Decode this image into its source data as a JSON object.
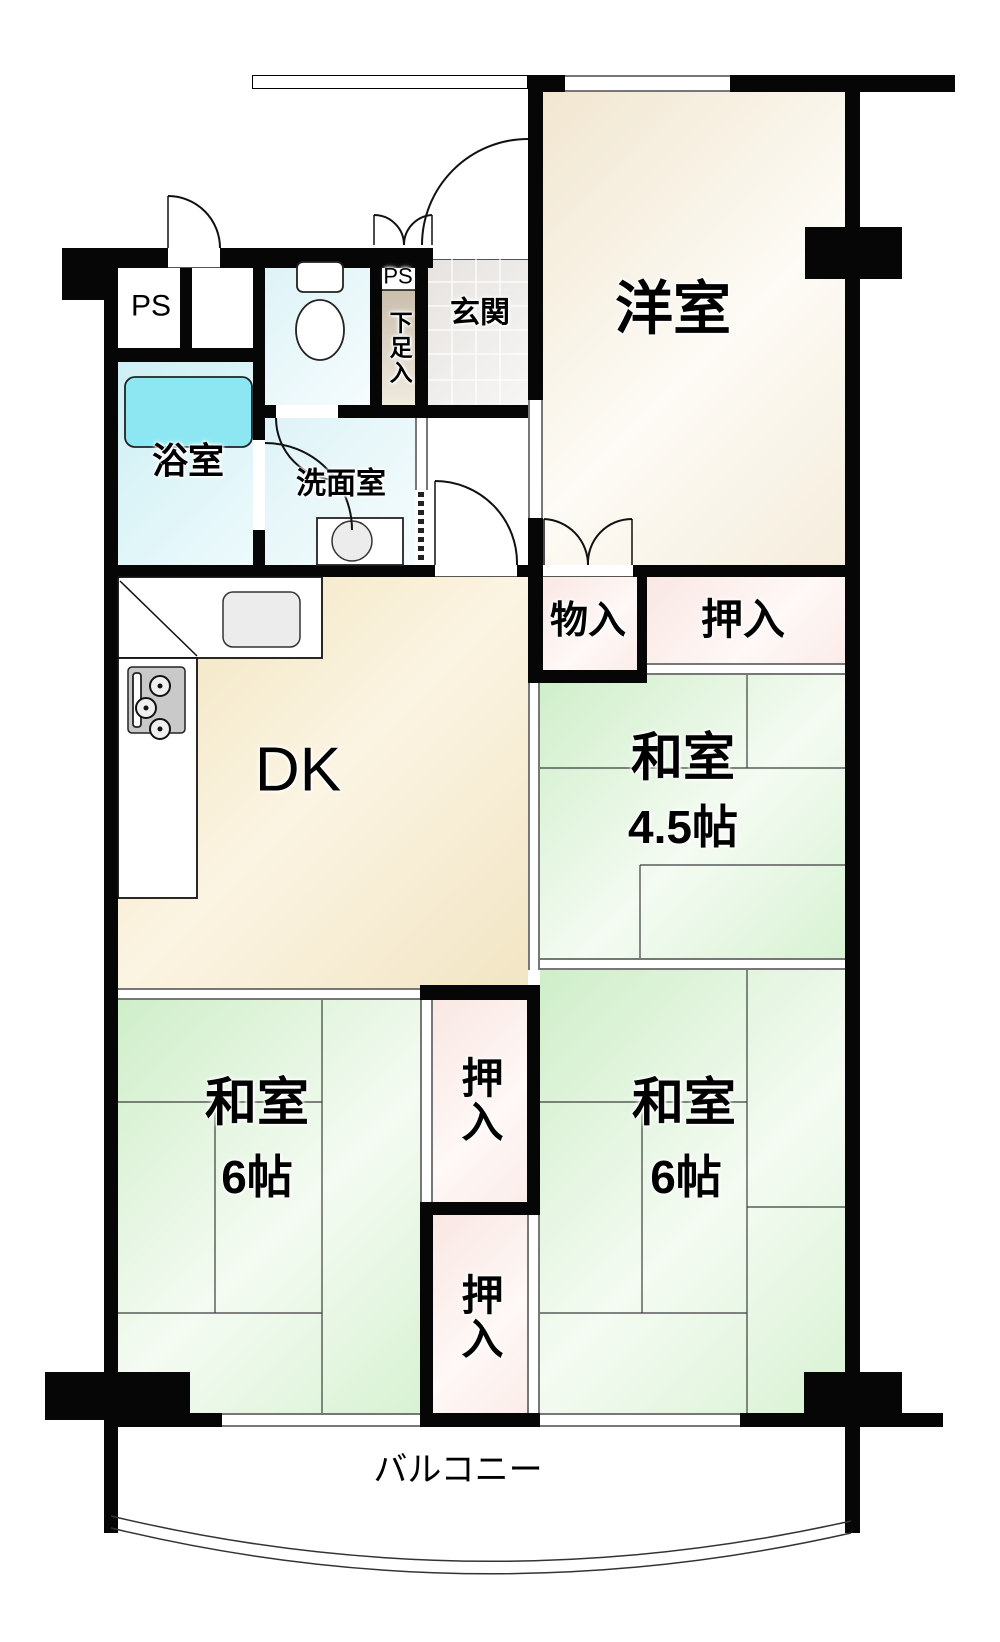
{
  "canvas": {
    "width": 1000,
    "height": 1642,
    "background": "#ffffff"
  },
  "colors": {
    "wall": "#060606",
    "tatami_green": "#d8f2d3",
    "room_cream": "#f5eddd",
    "dk_cream": "#f2e5c4",
    "closet_pink": "#fbece9",
    "bath_cyan": "#cdeff4",
    "tub_cyan": "#8ce7f2",
    "shoe_beige": "#c9beac"
  },
  "rooms": [
    {
      "name": "western-room",
      "fill": "western",
      "x": 543,
      "y": 92,
      "w": 302,
      "h": 473
    },
    {
      "name": "ps-left",
      "fill": "white",
      "x": 116,
      "y": 268,
      "w": 64,
      "h": 80
    },
    {
      "name": "ps-left-2",
      "fill": "white",
      "x": 192,
      "y": 268,
      "w": 61,
      "h": 80
    },
    {
      "name": "toilet-room",
      "fill": "wash",
      "x": 265,
      "y": 268,
      "w": 105,
      "h": 137
    },
    {
      "name": "ps-small-box",
      "fill": "white",
      "x": 382,
      "y": 262,
      "w": 33,
      "h": 28
    },
    {
      "name": "shoe-cabinet",
      "fill": "shoe",
      "x": 382,
      "y": 290,
      "w": 33,
      "h": 115
    },
    {
      "name": "entrance",
      "fill": "tile",
      "x": 428,
      "y": 258,
      "w": 100,
      "h": 147
    },
    {
      "name": "bathroom",
      "fill": "bath",
      "x": 116,
      "y": 362,
      "w": 137,
      "h": 203
    },
    {
      "name": "washroom",
      "fill": "wash",
      "x": 265,
      "y": 418,
      "w": 150,
      "h": 147
    },
    {
      "name": "hallway",
      "fill": "white",
      "x": 428,
      "y": 418,
      "w": 100,
      "h": 147
    },
    {
      "name": "storage-mono",
      "fill": "closet",
      "x": 540,
      "y": 577,
      "w": 97,
      "h": 93
    },
    {
      "name": "closet-top",
      "fill": "closet",
      "x": 647,
      "y": 577,
      "w": 198,
      "h": 86
    },
    {
      "name": "dk-room",
      "fill": "dk",
      "x": 118,
      "y": 577,
      "w": 410,
      "h": 411
    },
    {
      "name": "washitsu-45",
      "fill": "tatami",
      "x": 540,
      "y": 675,
      "w": 305,
      "h": 283
    },
    {
      "name": "washitsu-6-left",
      "fill": "tatami",
      "x": 118,
      "y": 1000,
      "w": 302,
      "h": 413
    },
    {
      "name": "closet-mid-upper",
      "fill": "closet",
      "x": 433,
      "y": 1000,
      "w": 94,
      "h": 202
    },
    {
      "name": "closet-mid-lower",
      "fill": "closet",
      "x": 433,
      "y": 1215,
      "w": 94,
      "h": 198
    },
    {
      "name": "washitsu-6-right",
      "fill": "tatami",
      "x": 540,
      "y": 970,
      "w": 305,
      "h": 443
    },
    {
      "name": "balcony",
      "fill": "white",
      "x": 118,
      "y": 1427,
      "w": 727,
      "h": 95
    }
  ],
  "walls": [
    {
      "name": "pillar-top-left",
      "x": 62,
      "y": 248,
      "w": 54,
      "h": 52
    },
    {
      "name": "wall-top-a",
      "x": 116,
      "y": 248,
      "w": 52,
      "h": 20
    },
    {
      "name": "wall-top-b",
      "x": 220,
      "y": 248,
      "w": 213,
      "h": 20
    },
    {
      "name": "wall-left-outer",
      "x": 104,
      "y": 248,
      "w": 14,
      "h": 1285
    },
    {
      "name": "wall-ps-divider",
      "x": 180,
      "y": 268,
      "w": 12,
      "h": 87
    },
    {
      "name": "wall-under-ps",
      "x": 116,
      "y": 348,
      "w": 149,
      "h": 14
    },
    {
      "name": "wall-bath-right-a",
      "x": 253,
      "y": 248,
      "w": 12,
      "h": 192
    },
    {
      "name": "wall-bath-right-b",
      "x": 253,
      "y": 530,
      "w": 12,
      "h": 47
    },
    {
      "name": "wall-toilet-right",
      "x": 370,
      "y": 248,
      "w": 12,
      "h": 157
    },
    {
      "name": "wall-toilet-bottom-a",
      "x": 253,
      "y": 405,
      "w": 23,
      "h": 13
    },
    {
      "name": "wall-toilet-bottom-b",
      "x": 338,
      "y": 405,
      "w": 190,
      "h": 13
    },
    {
      "name": "wall-shoe-right",
      "x": 415,
      "y": 262,
      "w": 13,
      "h": 143
    },
    {
      "name": "wall-western-left-upper",
      "x": 528,
      "y": 75,
      "w": 15,
      "h": 325
    },
    {
      "name": "wall-western-left-lower",
      "x": 528,
      "y": 518,
      "w": 15,
      "h": 165
    },
    {
      "name": "wall-top-western-a",
      "x": 543,
      "y": 75,
      "w": 22,
      "h": 17
    },
    {
      "name": "wall-top-western-b",
      "x": 730,
      "y": 75,
      "w": 225,
      "h": 17
    },
    {
      "name": "wall-right-outer",
      "x": 845,
      "y": 75,
      "w": 15,
      "h": 1458
    },
    {
      "name": "pillar-right",
      "x": 805,
      "y": 227,
      "w": 97,
      "h": 52
    },
    {
      "name": "wall-dk-top",
      "x": 104,
      "y": 565,
      "w": 331,
      "h": 12
    },
    {
      "name": "wall-hall-stub",
      "x": 517,
      "y": 565,
      "w": 26,
      "h": 12
    },
    {
      "name": "wall-western-bottom",
      "x": 633,
      "y": 565,
      "w": 212,
      "h": 12
    },
    {
      "name": "wall-mono-right",
      "x": 637,
      "y": 565,
      "w": 10,
      "h": 118
    },
    {
      "name": "wall-mono-bottom",
      "x": 528,
      "y": 670,
      "w": 119,
      "h": 13
    },
    {
      "name": "wall-closetcol-top",
      "x": 420,
      "y": 985,
      "w": 120,
      "h": 15
    },
    {
      "name": "wall-closetcol-right",
      "x": 527,
      "y": 1000,
      "w": 13,
      "h": 215
    },
    {
      "name": "wall-closetcol-mid",
      "x": 420,
      "y": 1202,
      "w": 120,
      "h": 13
    },
    {
      "name": "wall-closetcol-left",
      "x": 420,
      "y": 1215,
      "w": 13,
      "h": 198
    },
    {
      "name": "wall-closetcol-bottom",
      "x": 420,
      "y": 1413,
      "w": 120,
      "h": 14
    },
    {
      "name": "wall-bottom-left",
      "x": 104,
      "y": 1413,
      "w": 118,
      "h": 14
    },
    {
      "name": "wall-bottom-right",
      "x": 740,
      "y": 1413,
      "w": 203,
      "h": 14
    },
    {
      "name": "pillar-bottom-left",
      "x": 45,
      "y": 1372,
      "w": 145,
      "h": 48
    },
    {
      "name": "pillar-bottom-right",
      "x": 804,
      "y": 1372,
      "w": 98,
      "h": 46
    }
  ],
  "openings": [
    {
      "name": "window-western-top",
      "type": "window-h",
      "x": 565,
      "y": 75,
      "w": 165,
      "h": 17
    },
    {
      "name": "corridor-railing",
      "type": "railing",
      "x": 252,
      "y": 75,
      "w": 276,
      "h": 14
    },
    {
      "name": "entrance-door-sill",
      "type": "sill-h",
      "x": 433,
      "y": 245,
      "w": 95,
      "h": 15
    },
    {
      "name": "ps-door-sill",
      "type": "sill-h",
      "x": 168,
      "y": 248,
      "w": 52,
      "h": 20
    },
    {
      "name": "slider-hall-western",
      "type": "window-v",
      "x": 528,
      "y": 400,
      "w": 15,
      "h": 118
    },
    {
      "name": "slider-washroom",
      "type": "window-v",
      "x": 415,
      "y": 418,
      "w": 13,
      "h": 72
    },
    {
      "name": "dk-door-sill",
      "type": "sill-h",
      "x": 435,
      "y": 565,
      "w": 82,
      "h": 12
    },
    {
      "name": "mono-bifold-sill",
      "type": "sill-h",
      "x": 543,
      "y": 565,
      "w": 90,
      "h": 12
    },
    {
      "name": "closet-top-front",
      "type": "window-h",
      "x": 647,
      "y": 663,
      "w": 198,
      "h": 12
    },
    {
      "name": "slider-dk-washitsu45",
      "type": "window-v",
      "x": 528,
      "y": 683,
      "w": 12,
      "h": 287
    },
    {
      "name": "slider-washitsu45-6r",
      "type": "window-h",
      "x": 540,
      "y": 958,
      "w": 305,
      "h": 12
    },
    {
      "name": "slider-dk-washitsu6l",
      "type": "window-h",
      "x": 118,
      "y": 988,
      "w": 302,
      "h": 12
    },
    {
      "name": "closet-upper-front",
      "type": "window-v",
      "x": 420,
      "y": 1000,
      "w": 13,
      "h": 202
    },
    {
      "name": "closet-lower-front",
      "type": "window-v",
      "x": 527,
      "y": 1215,
      "w": 13,
      "h": 198
    },
    {
      "name": "window-balcony-left",
      "type": "window-h",
      "x": 222,
      "y": 1413,
      "w": 198,
      "h": 14
    },
    {
      "name": "window-balcony-right",
      "type": "window-h",
      "x": 540,
      "y": 1413,
      "w": 200,
      "h": 14
    }
  ],
  "svg": [
    {
      "k": "rect",
      "cls": "counter",
      "name": "kitchen-counter-top",
      "x": 118,
      "y": 577,
      "width": 204,
      "height": 81
    },
    {
      "k": "rect",
      "cls": "counter",
      "name": "kitchen-counter-left",
      "x": 118,
      "y": 658,
      "width": 79,
      "height": 240
    },
    {
      "k": "line",
      "cls": "ln",
      "name": "counter-diagonal",
      "x1": 120,
      "y1": 581,
      "x2": 197,
      "y2": 656
    },
    {
      "k": "rect",
      "cls": "fixg",
      "name": "kitchen-sink",
      "x": 223,
      "y": 592,
      "width": 77,
      "height": 55,
      "rx": 10
    },
    {
      "k": "rect",
      "cls": "stove",
      "name": "gas-stove",
      "x": 128,
      "y": 667,
      "width": 57,
      "height": 66,
      "rx": 4
    },
    {
      "k": "rect",
      "cls": "fix",
      "name": "stove-grill",
      "x": 133,
      "y": 673,
      "width": 8,
      "height": 54,
      "rx": 3
    },
    {
      "k": "circle",
      "cls": "burner",
      "name": "burner-1",
      "cx": 160,
      "cy": 686,
      "r": 10
    },
    {
      "k": "circle",
      "cls": "burner",
      "name": "burner-2",
      "cx": 146,
      "cy": 708,
      "r": 10
    },
    {
      "k": "circle",
      "cls": "burner",
      "name": "burner-3",
      "cx": 160,
      "cy": 729,
      "r": 10
    },
    {
      "k": "circle",
      "cls": "dot",
      "name": "burner-dot-1",
      "cx": 160,
      "cy": 686,
      "r": 2.5
    },
    {
      "k": "circle",
      "cls": "dot",
      "name": "burner-dot-2",
      "cx": 146,
      "cy": 708,
      "r": 2.5
    },
    {
      "k": "circle",
      "cls": "dot",
      "name": "burner-dot-3",
      "cx": 160,
      "cy": 729,
      "r": 2.5
    },
    {
      "k": "rect",
      "cls": "tub",
      "name": "bathtub",
      "x": 125,
      "y": 377,
      "width": 127,
      "height": 70,
      "rx": 10
    },
    {
      "k": "rect",
      "cls": "fix",
      "name": "toilet-tank",
      "x": 297,
      "y": 262,
      "width": 46,
      "height": 30,
      "rx": 6
    },
    {
      "k": "ellipse",
      "cls": "fix",
      "name": "toilet-bowl",
      "cx": 320,
      "cy": 330,
      "rx": 24,
      "ry": 30
    },
    {
      "k": "rect",
      "cls": "fix",
      "name": "wash-basin",
      "x": 317,
      "y": 518,
      "width": 86,
      "height": 47
    },
    {
      "k": "circle",
      "cls": "fixg",
      "name": "wash-basin-bowl",
      "cx": 352,
      "cy": 541,
      "r": 20
    },
    {
      "k": "line",
      "cls": "grid",
      "name": "tile-line",
      "x1": 452,
      "y1": 258,
      "x2": 452,
      "y2": 405
    },
    {
      "k": "line",
      "cls": "grid",
      "name": "tile-line",
      "x1": 476,
      "y1": 258,
      "x2": 476,
      "y2": 405
    },
    {
      "k": "line",
      "cls": "grid",
      "name": "tile-line",
      "x1": 500,
      "y1": 258,
      "x2": 500,
      "y2": 405
    },
    {
      "k": "line",
      "cls": "grid",
      "name": "tile-line",
      "x1": 428,
      "y1": 282,
      "x2": 528,
      "y2": 282
    },
    {
      "k": "line",
      "cls": "grid",
      "name": "tile-line",
      "x1": 428,
      "y1": 306,
      "x2": 528,
      "y2": 306
    },
    {
      "k": "line",
      "cls": "grid",
      "name": "tile-line",
      "x1": 428,
      "y1": 330,
      "x2": 528,
      "y2": 330
    },
    {
      "k": "line",
      "cls": "grid",
      "name": "tile-line",
      "x1": 428,
      "y1": 354,
      "x2": 528,
      "y2": 354
    },
    {
      "k": "line",
      "cls": "grid",
      "name": "tile-line",
      "x1": 428,
      "y1": 380,
      "x2": 528,
      "y2": 380
    },
    {
      "k": "path",
      "cls": "door",
      "name": "entrance-door-arc",
      "d": "M422,245 A106,106 0 0 1 528,139"
    },
    {
      "k": "path",
      "cls": "door",
      "name": "ps-door-arc",
      "d": "M168,196 A52,52 0 0 1 220,248"
    },
    {
      "k": "line",
      "cls": "ln",
      "name": "ps-door-leaf",
      "x1": 168,
      "y1": 196,
      "x2": 168,
      "y2": 248
    },
    {
      "k": "path",
      "cls": "door",
      "name": "service-bifold-left",
      "d": "M374,215 A30,30 0 0 1 404,245"
    },
    {
      "k": "path",
      "cls": "door",
      "name": "service-bifold-right",
      "d": "M432,215 A30,30 0 0 0 404,245"
    },
    {
      "k": "line",
      "cls": "ln",
      "name": "service-bifold-leaf-l",
      "x1": 374,
      "y1": 215,
      "x2": 374,
      "y2": 245
    },
    {
      "k": "line",
      "cls": "ln",
      "name": "service-bifold-leaf-r",
      "x1": 432,
      "y1": 215,
      "x2": 432,
      "y2": 245
    },
    {
      "k": "path",
      "cls": "door",
      "name": "toilet-door-arc",
      "d": "M276,418 A62,62 0 0 0 338,480"
    },
    {
      "k": "path",
      "cls": "door",
      "name": "bath-door-arc",
      "d": "M265,443 A87,87 0 0 1 352,530"
    },
    {
      "k": "path",
      "cls": "door",
      "name": "dk-door-arc",
      "d": "M435,481 A82,82 0 0 1 517,565"
    },
    {
      "k": "line",
      "cls": "ln",
      "name": "dk-door-leaf",
      "x1": 435,
      "y1": 481,
      "x2": 435,
      "y2": 565
    },
    {
      "k": "path",
      "cls": "door",
      "name": "mono-bifold-left",
      "d": "M544,519 A46,46 0 0 1 588,565"
    },
    {
      "k": "path",
      "cls": "door",
      "name": "mono-bifold-right",
      "d": "M632,519 A44,44 0 0 0 588,565"
    },
    {
      "k": "line",
      "cls": "ln",
      "name": "mono-bifold-leaf-l",
      "x1": 544,
      "y1": 519,
      "x2": 544,
      "y2": 565
    },
    {
      "k": "line",
      "cls": "ln",
      "name": "mono-bifold-leaf-r",
      "x1": 632,
      "y1": 519,
      "x2": 632,
      "y2": 565
    },
    {
      "k": "line",
      "cls": "dash",
      "name": "accordion-door",
      "x1": 421,
      "y1": 492,
      "x2": 421,
      "y2": 563
    },
    {
      "k": "line",
      "cls": "ln",
      "name": "shoe-top-line",
      "x1": 382,
      "y1": 290,
      "x2": 415,
      "y2": 290
    },
    {
      "k": "line",
      "cls": "thin",
      "name": "tatami",
      "x1": 540,
      "y1": 768,
      "x2": 845,
      "y2": 768
    },
    {
      "k": "line",
      "cls": "thin",
      "name": "tatami",
      "x1": 747,
      "y1": 675,
      "x2": 747,
      "y2": 768
    },
    {
      "k": "line",
      "cls": "thin",
      "name": "tatami",
      "x1": 640,
      "y1": 865,
      "x2": 845,
      "y2": 865
    },
    {
      "k": "line",
      "cls": "thin",
      "name": "tatami",
      "x1": 640,
      "y1": 865,
      "x2": 640,
      "y2": 958
    },
    {
      "k": "line",
      "cls": "thin",
      "name": "tatami",
      "x1": 322,
      "y1": 1000,
      "x2": 322,
      "y2": 1413
    },
    {
      "k": "line",
      "cls": "thin",
      "name": "tatami",
      "x1": 118,
      "y1": 1102,
      "x2": 322,
      "y2": 1102
    },
    {
      "k": "line",
      "cls": "thin",
      "name": "tatami",
      "x1": 215,
      "y1": 1102,
      "x2": 215,
      "y2": 1313
    },
    {
      "k": "line",
      "cls": "thin",
      "name": "tatami",
      "x1": 118,
      "y1": 1313,
      "x2": 322,
      "y2": 1313
    },
    {
      "k": "line",
      "cls": "thin",
      "name": "tatami",
      "x1": 747,
      "y1": 970,
      "x2": 747,
      "y2": 1413
    },
    {
      "k": "line",
      "cls": "thin",
      "name": "tatami",
      "x1": 540,
      "y1": 1102,
      "x2": 747,
      "y2": 1102
    },
    {
      "k": "line",
      "cls": "thin",
      "name": "tatami",
      "x1": 642,
      "y1": 1102,
      "x2": 642,
      "y2": 1313
    },
    {
      "k": "line",
      "cls": "thin",
      "name": "tatami",
      "x1": 540,
      "y1": 1313,
      "x2": 747,
      "y2": 1313
    },
    {
      "k": "line",
      "cls": "thin",
      "name": "tatami",
      "x1": 747,
      "y1": 1207,
      "x2": 845,
      "y2": 1207
    },
    {
      "k": "path",
      "cls": "barc",
      "name": "balcony-edge-outer",
      "d": "M111,1516 Q480,1604 851,1521"
    },
    {
      "k": "path",
      "cls": "barc",
      "name": "balcony-edge-inner",
      "d": "M111,1528 Q480,1617 851,1533"
    }
  ],
  "labels": [
    {
      "name": "label-ps-main",
      "text": "PS",
      "x": 151,
      "y": 306,
      "size": 30,
      "weight": 400
    },
    {
      "name": "label-ps-small",
      "text": "PS",
      "x": 398,
      "y": 276,
      "size": 22,
      "weight": 400
    },
    {
      "name": "label-shoe",
      "text": "下足入",
      "x": 399,
      "y": 348,
      "size": 23,
      "weight": 700,
      "vertical": true
    },
    {
      "name": "label-entrance",
      "text": "玄関",
      "x": 480,
      "y": 313,
      "size": 30,
      "weight": 700
    },
    {
      "name": "label-western",
      "text": "洋室",
      "x": 673,
      "y": 310,
      "size": 58,
      "weight": 700
    },
    {
      "name": "label-bath",
      "text": "浴室",
      "x": 188,
      "y": 461,
      "size": 36,
      "weight": 700
    },
    {
      "name": "label-washroom",
      "text": "洗面室",
      "x": 341,
      "y": 484,
      "size": 30,
      "weight": 700
    },
    {
      "name": "label-mono",
      "text": "物入",
      "x": 588,
      "y": 622,
      "size": 38,
      "weight": 700
    },
    {
      "name": "label-closet-tr",
      "text": "押入",
      "x": 743,
      "y": 620,
      "size": 42,
      "weight": 700
    },
    {
      "name": "label-wa45-a",
      "text": "和室",
      "x": 683,
      "y": 759,
      "size": 52,
      "weight": 700
    },
    {
      "name": "label-wa45-b",
      "text": "4.5帖",
      "x": 683,
      "y": 827,
      "size": 46,
      "weight": 700
    },
    {
      "name": "label-dk",
      "text": "DK",
      "x": 298,
      "y": 770,
      "size": 62,
      "weight": 400
    },
    {
      "name": "label-wa6l-a",
      "text": "和室",
      "x": 257,
      "y": 1104,
      "size": 52,
      "weight": 700
    },
    {
      "name": "label-wa6l-b",
      "text": "6帖",
      "x": 257,
      "y": 1177,
      "size": 46,
      "weight": 700
    },
    {
      "name": "label-wa6r-a",
      "text": "和室",
      "x": 684,
      "y": 1104,
      "size": 52,
      "weight": 700
    },
    {
      "name": "label-wa6r-b",
      "text": "6帖",
      "x": 686,
      "y": 1177,
      "size": 46,
      "weight": 700
    },
    {
      "name": "label-closet-up",
      "text": "押入",
      "x": 479,
      "y": 1100,
      "size": 42,
      "weight": 700,
      "vertical": true
    },
    {
      "name": "label-closet-lo",
      "text": "押入",
      "x": 479,
      "y": 1317,
      "size": 42,
      "weight": 700,
      "vertical": true
    },
    {
      "name": "label-balcony",
      "text": "バルコニー",
      "x": 458,
      "y": 1471,
      "size": 34,
      "weight": 400
    }
  ]
}
